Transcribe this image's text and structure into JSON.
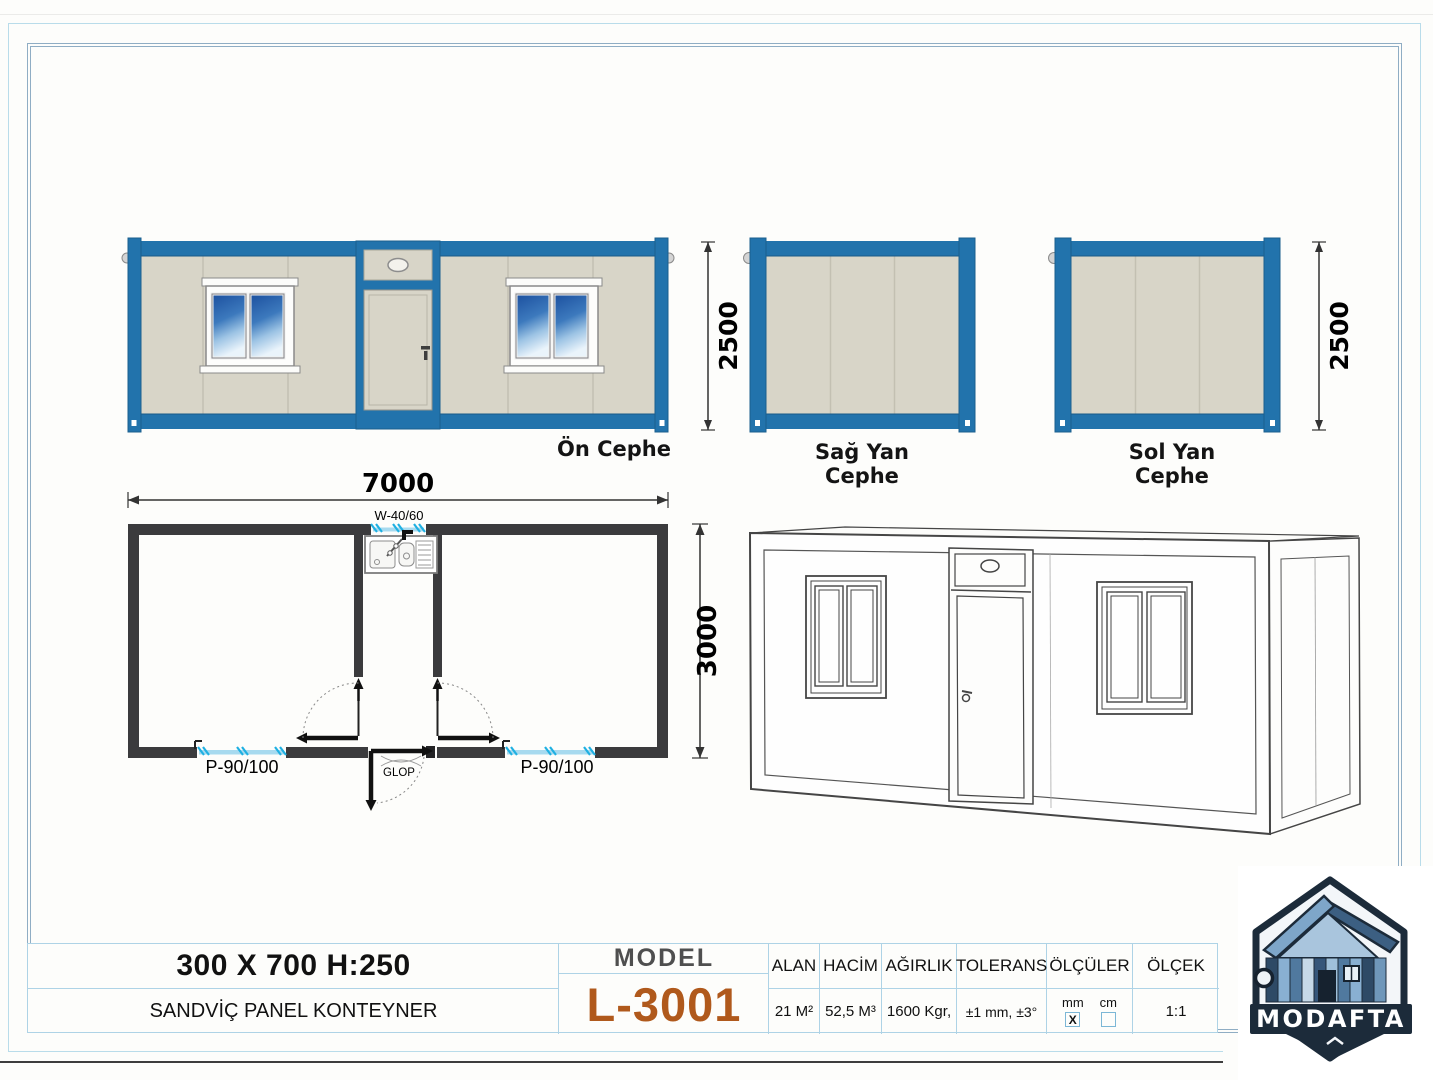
{
  "views": {
    "front": {
      "label": "Ön Cephe",
      "height_dim": "2500"
    },
    "right_side": {
      "label": "Sağ Yan Cephe"
    },
    "left_side": {
      "label": "Sol Yan Cephe",
      "height_dim": "2500"
    },
    "plan": {
      "width_dim": "7000",
      "depth_dim": "3000",
      "top_window_label": "W-40/60",
      "left_window_label": "P-90/100",
      "right_window_label": "P-90/100",
      "door_label": "GLOP"
    }
  },
  "title_block": {
    "size_title": "300 X 700 H:250",
    "product_name": "SANDVİÇ PANEL KONTEYNER",
    "model_label": "MODEL",
    "model_value": "L-3001",
    "spec_table": {
      "columns": [
        "ALAN",
        "HACİM",
        "AĞIRLIK",
        "TOLERANS",
        "ÖLÇÜLER",
        "ÖLÇEK"
      ],
      "alan_value": "21 M²",
      "hacim_value": "52,5 M³",
      "agirlik_value": "1600 Kgr,",
      "tolerans_value": "±1 mm, ±3°",
      "olculer": {
        "mm_label": "mm",
        "cm_label": "cm",
        "mm_check": "X"
      },
      "olcek_value": "1:1"
    }
  },
  "logo": {
    "brand": "MODAFTA"
  },
  "colors": {
    "container_blue": "#2273ac",
    "panel_beige": "#d8d5c8",
    "wall_dark": "#3b3b3d",
    "glazing_blue": "#a7daef",
    "tick_cyan": "#1fb0e2",
    "table_border": "#aed3e6",
    "model_orange": "#b0591c",
    "logo_navy": "#1c2b3a"
  }
}
